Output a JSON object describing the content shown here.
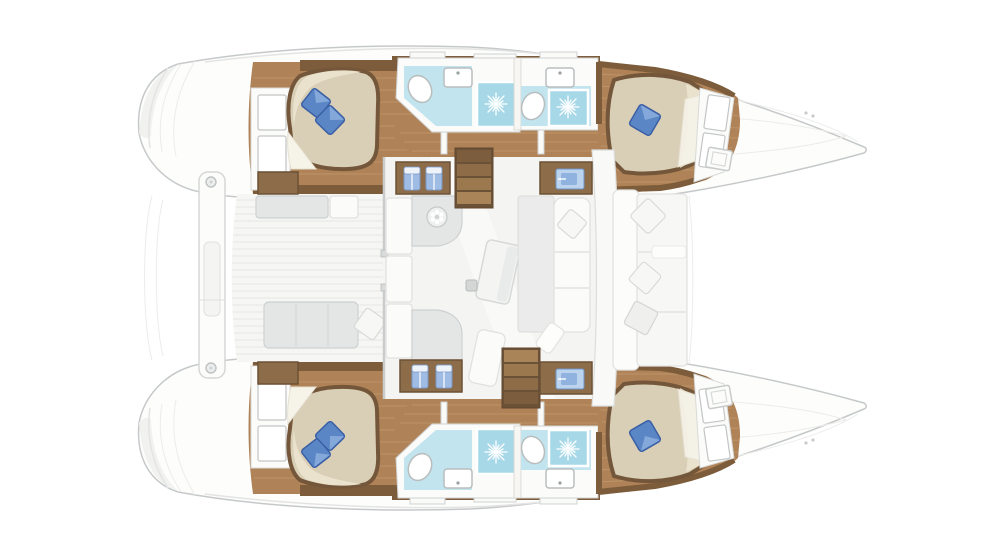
{
  "floor_plan": {
    "view": "overhead",
    "vessel_type": "sailing-catamaran",
    "orientation": {
      "bow": "right",
      "stern": "left",
      "symmetry": "mirrored-hulls"
    },
    "hulls": [
      {
        "id": "upper-hull",
        "areas": [
          {
            "name": "aft cabin",
            "features": [
              "double berth",
              "2 blue pillows",
              "white sheet fold",
              "wardrobe shelves",
              "wood floor"
            ]
          },
          {
            "name": "aft head",
            "fixtures": [
              "toilet",
              "washbasin",
              "shower with drain rose"
            ]
          },
          {
            "name": "companionway corridor",
            "features": [
              "wood floor",
              "door jambs"
            ]
          },
          {
            "name": "forward head",
            "fixtures": [
              "toilet",
              "washbasin",
              "shower with drain rose"
            ]
          },
          {
            "name": "forward cabin",
            "features": [
              "double berth",
              "1 blue pillow",
              "white sheet fold",
              "wardrobe shelves"
            ]
          }
        ]
      },
      {
        "id": "lower-hull",
        "mirror_of": "upper-hull"
      }
    ],
    "bridgedeck": {
      "aft_cockpit": [
        "transom crossbeam platform",
        "2 mooring rings",
        "upper bench seat",
        "lower bench seat",
        "1 white scatter cushion",
        "teak deck planking",
        "2 wood step lockers"
      ],
      "salon": [
        "galley counter with round sink",
        "side storage cabinets",
        "tilted dining table",
        "settee with white cushion",
        "chaise bench",
        "mast step",
        "upper companionway stairs (4 treads)",
        "lower companionway stairs (4 treads)",
        "2 towel lockers (2 blue towels each)",
        "2 vanity lockers with blue basin"
      ],
      "forward_cockpit": [
        "lounge seat",
        "3 white scatter cushions"
      ],
      "foredeck": [
        "2 tilted deck hatches",
        "toe-rail lines",
        "cleat fittings"
      ]
    },
    "stern_details": [
      "transom steps (3 arcs per hull)"
    ],
    "counts": {
      "cabins": 4,
      "heads": 4,
      "showers": 4,
      "blue_pillows": 6,
      "white_cushions": 5,
      "deck_hatches": 2,
      "stairs": 2
    }
  },
  "colors": {
    "hull_fill": "#fdfdfc",
    "hull_stroke": "#c6c9ca",
    "deck_line": "#e3e4e3",
    "shade": "#f1f1f0",
    "wood_floor": "#b08257",
    "wood_floor_light": "#c7a378",
    "wood_wall": "#7c5c3a",
    "wood_cabinet": "#8d6c49",
    "wood_cabinet_dark": "#6b5136",
    "stair_dark": "#7c5e3e",
    "stair_light": "#a5815a",
    "bath_wall": "#fbfbfa",
    "bath_floor": "#c2e4ef",
    "shower_tile": "#a6d8e8",
    "fixture_stroke": "#b9bdbe",
    "bed_rim": "#74573a",
    "bed_fill": "#d9cfb6",
    "bed_highlight": "#eae2cd",
    "sheet_white": "#f6f3e9",
    "pillow_blue": "#5b86c6",
    "pillow_blue_dark": "#3a5fa5",
    "pillow_blue_light": "#93b3e2",
    "towel_blue": "#9fbce4",
    "towel_blue_dark": "#7b97c4",
    "accent_item_blue": "#8fb2de",
    "gray_furniture": "#e4e6e6",
    "gray_furniture_stroke": "#ced1d1",
    "salon_floor": "#f4f4f3",
    "teak_line": "#e7e7e5",
    "white_furniture": "#fbfbfa",
    "white_furniture_stroke": "#e1e2e0"
  }
}
